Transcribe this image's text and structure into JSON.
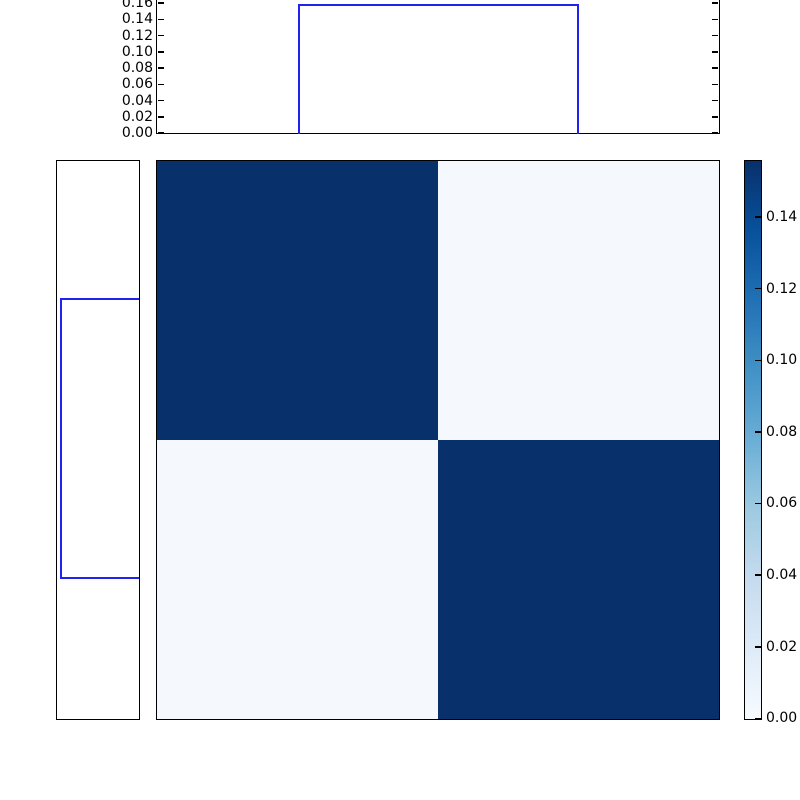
{
  "palette": {
    "heat_dark": "#08306b",
    "heat_light": "#f5f9fd",
    "step_line_blue": "#2222ee",
    "frame": "#000000",
    "background": "#ffffff"
  },
  "chart_data": {
    "type": "heatmap",
    "description": "2x2 joint-probability heatmap (Blues colormap) with step-histogram marginals on top and left, and a vertical colorbar on the right",
    "matrix": {
      "rows": 2,
      "cols": 2,
      "values": [
        [
          0.156,
          0.002
        ],
        [
          0.002,
          0.156
        ]
      ],
      "vmin": 0.0,
      "vmax": 0.156,
      "colormap": "Blues"
    },
    "top_marginal": {
      "type": "step-histogram",
      "line_color": "#2222ee",
      "ylim": [
        0.0,
        0.163
      ],
      "tick_step": 0.02,
      "tick_labels": [
        "0.16",
        "0.14",
        "0.12",
        "0.10",
        "0.08",
        "0.06",
        "0.04",
        "0.02",
        "0.00"
      ],
      "bar": {
        "span_frac": [
          0.25,
          0.75
        ],
        "height": 0.156
      }
    },
    "left_marginal": {
      "type": "step-histogram",
      "line_color": "#2222ee",
      "value_axis": "horizontal, 0 at right edge, increasing leftward",
      "xlim": [
        0.163,
        0.0
      ],
      "tick_labels": [],
      "bar": {
        "span_frac": [
          0.25,
          0.75
        ],
        "height": 0.156
      }
    },
    "colorbar": {
      "min": 0.0,
      "max": 0.156,
      "tick_step": 0.02,
      "tick_labels": [
        "0.14",
        "0.12",
        "0.10",
        "0.08",
        "0.06",
        "0.04",
        "0.02",
        "0.00"
      ]
    },
    "title": "",
    "xlabel": "",
    "ylabel": "",
    "grid": false,
    "legend": null
  }
}
